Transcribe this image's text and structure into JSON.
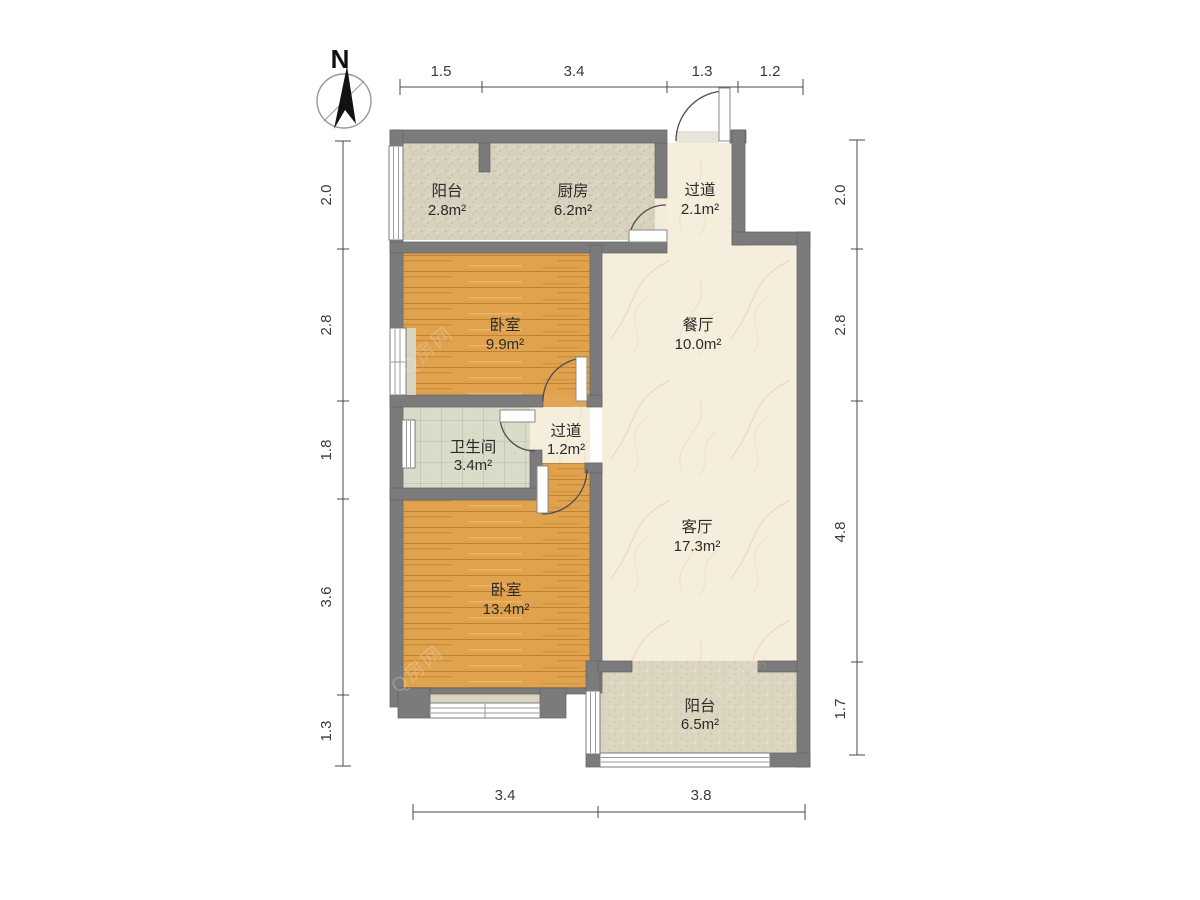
{
  "compass": {
    "label": "N"
  },
  "rooms": [
    {
      "id": "balcony-north",
      "name": "阳台",
      "area": "2.8m²"
    },
    {
      "id": "kitchen",
      "name": "厨房",
      "area": "6.2m²"
    },
    {
      "id": "hallway-entry",
      "name": "过道",
      "area": "2.1m²"
    },
    {
      "id": "bedroom-north",
      "name": "卧室",
      "area": "9.9m²"
    },
    {
      "id": "dining-room",
      "name": "餐厅",
      "area": "10.0m²"
    },
    {
      "id": "bathroom",
      "name": "卫生间",
      "area": "3.4m²"
    },
    {
      "id": "hallway-inner",
      "name": "过道",
      "area": "1.2m²"
    },
    {
      "id": "living-room",
      "name": "客厅",
      "area": "17.3m²"
    },
    {
      "id": "bedroom-south",
      "name": "卧室",
      "area": "13.4m²"
    },
    {
      "id": "balcony-south",
      "name": "阳台",
      "area": "6.5m²"
    }
  ],
  "dimensions": {
    "top": [
      "1.5",
      "3.4",
      "1.3",
      "1.2"
    ],
    "bottom": [
      "3.4",
      "3.8"
    ],
    "left": [
      "2.0",
      "2.8",
      "1.8",
      "3.6",
      "1.3"
    ],
    "right": [
      "2.0",
      "2.8",
      "4.8",
      "1.7"
    ]
  },
  "watermark": {
    "text": "Q房网"
  },
  "colors": {
    "wall": "#7b7b7b",
    "wood_floor": "#e0a24c",
    "marble_floor": "#f6eedc",
    "speckle_floor": "#d7d1bd",
    "tile_floor": "#dbdbca",
    "window": "#ffffff",
    "dimension_text": "#3a3a3a",
    "door_arc": "#4d4d4d"
  }
}
